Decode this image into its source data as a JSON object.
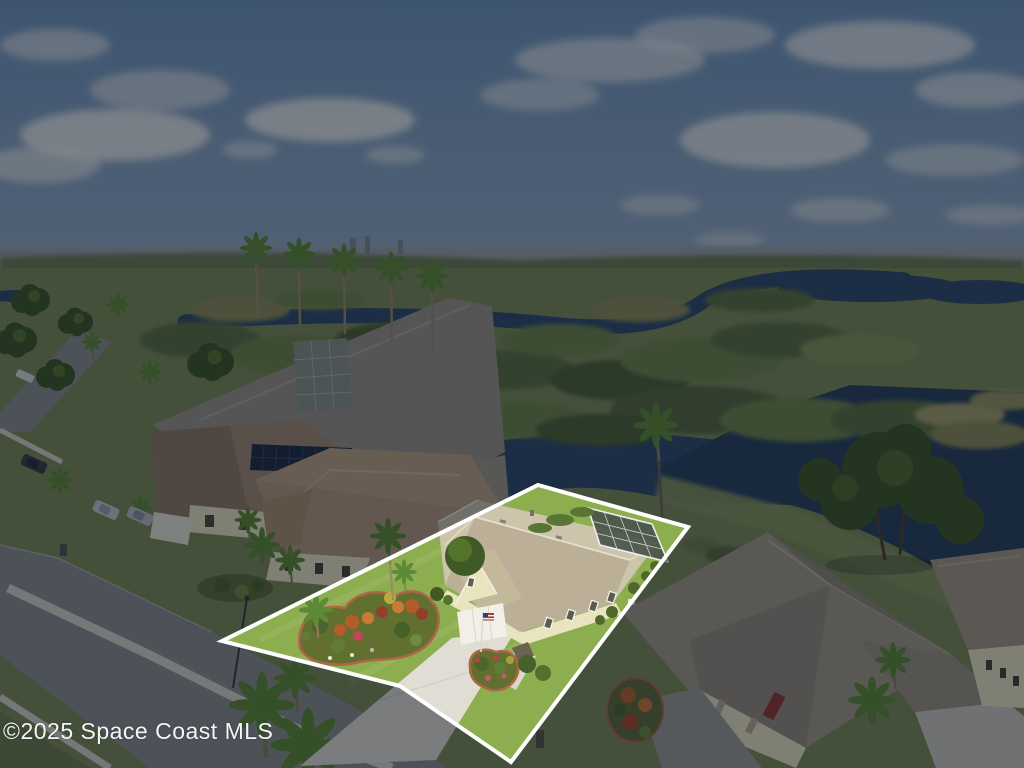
{
  "photo": {
    "type": "aerial-real-estate-photo",
    "watermark_text": "©2025 Space Coast MLS",
    "highlight": {
      "description": "waterfront single-family home lot outlined in white; surroundings dimmed",
      "lot_outline_points": "222,641 538,485 688,527 511,762 400,686"
    },
    "scene_elements": [
      "sky-with-clouds",
      "distant-horizon-homes",
      "wetland-preserve",
      "river-channel",
      "lake",
      "neighborhood-street",
      "parked-cars",
      "solar-panel-roof-house",
      "palm-trees",
      "highlighted-house",
      "screened-pool-enclosure",
      "driveway",
      "landscaped-beds",
      "american-flag",
      "neighbor-house-red-door",
      "oak-tree"
    ]
  },
  "colors": {
    "cloud": "#f2f3ef",
    "water": "#2e4a6a",
    "water_deep": "#27405e",
    "ground": "#7b8a58",
    "road": "#8b8e8e",
    "sidewalk": "#d5d3ca",
    "lawn": "#8cae4e",
    "drive": "#e0ded4",
    "roof_tan": "#cdc4ac",
    "wall_cream": "#e9e4c0",
    "roof_brown": "#b39a7e",
    "roof_gray": "#9a9488",
    "door_red": "#8e3532",
    "tree_dark": "#3c5524",
    "tree_lite": "#577430",
    "palm": "#5d8a36",
    "bank": "#86945c",
    "bed_edge": "#b06449",
    "outline": "#ffffff",
    "dim_overlay": "rgba(9,15,28,0.47)",
    "sky_top": "#6e93bc",
    "sky_bottom": "#95adc4"
  }
}
